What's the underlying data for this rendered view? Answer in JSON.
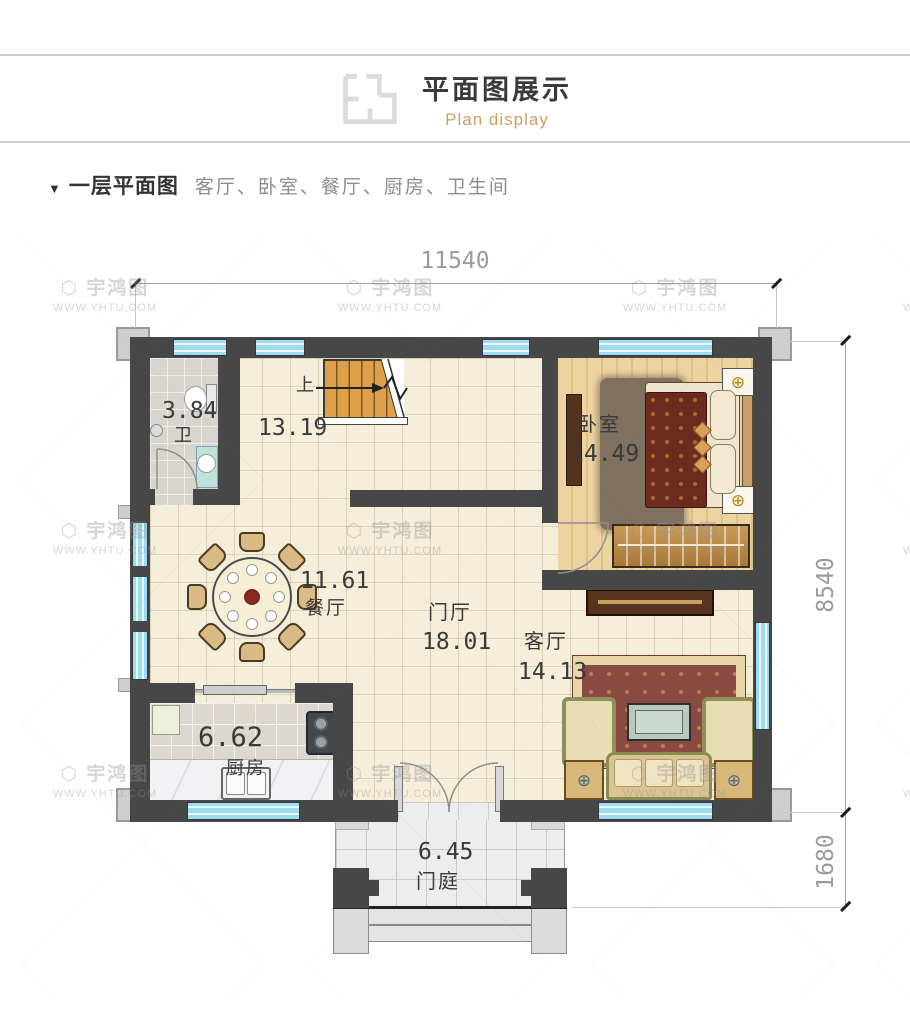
{
  "header": {
    "title": "平面图展示",
    "subtitle": "Plan display",
    "icon": "floorplan-icon"
  },
  "section": {
    "marker": "▼",
    "title": "一层平面图",
    "rooms_summary": "客厅、卧室、餐厅、厨房、卫生间"
  },
  "dimensions": {
    "width_top": "11540",
    "height_main": "8540",
    "depth_porch": "1680"
  },
  "plan": {
    "stair_up_label": "上",
    "rooms": {
      "bathroom": {
        "name": "卫",
        "area": "3.84"
      },
      "stair_hall": {
        "area": "13.19"
      },
      "bedroom": {
        "name": "卧室",
        "area": "14.49"
      },
      "dining": {
        "name": "餐厅",
        "area": "11.61"
      },
      "foyer": {
        "name": "门厅",
        "area": "18.01"
      },
      "living": {
        "name": "客厅",
        "area": "14.13"
      },
      "kitchen": {
        "name": "厨房",
        "area": "6.62"
      },
      "porch": {
        "name": "门庭",
        "area": "6.45"
      }
    }
  },
  "watermark": {
    "brand": "宇鸿图",
    "site": "WWW.YHTU.COM",
    "logo": "⬡"
  },
  "colors": {
    "wall": "#474747",
    "window_blue": "#9edcf2",
    "stair_orange": "#dfa04a",
    "accent_gold": "#c8a262",
    "floor_cream": "#f4eeda",
    "dim_text": "#9b9b9b"
  }
}
